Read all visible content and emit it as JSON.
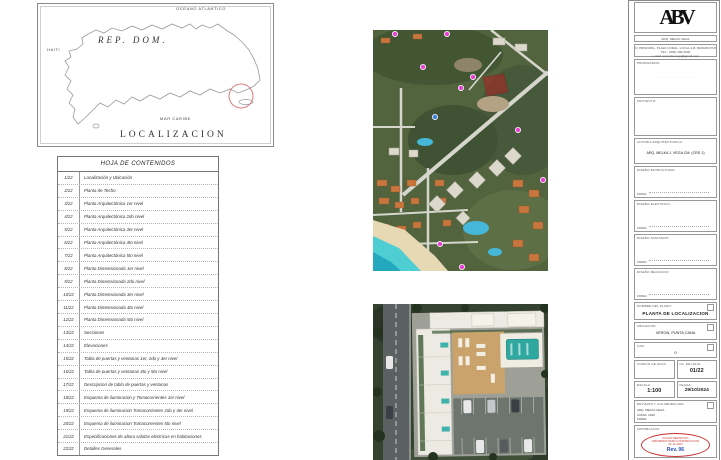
{
  "map": {
    "ocean": "OCEANO ATLANTICO",
    "country": "REP.  DOM.",
    "haiti": "HAITI",
    "sea": "MAR CARIBE",
    "title": "LOCALIZACION"
  },
  "toc": {
    "title": "HOJA DE CONTENIDOS",
    "rows": [
      {
        "n": "1/22",
        "d": "Localización y Ubicación"
      },
      {
        "n": "2/22",
        "d": "Planta de Techo"
      },
      {
        "n": "3/22",
        "d": "Planta  Arquitectónica   1er nivel"
      },
      {
        "n": "4/22",
        "d": "Planta  Arquitectónica   2do nivel"
      },
      {
        "n": "5/22",
        "d": "Planta  Arquitectónica   3er nivel"
      },
      {
        "n": "6/22",
        "d": "Planta  Arquitectónica   4to  nivel"
      },
      {
        "n": "7/22",
        "d": "Planta  Arquitectónica   5to  nivel"
      },
      {
        "n": "8/22",
        "d": "Planta  Dimensionada   1er nivel"
      },
      {
        "n": "9/22",
        "d": "Planta  Dimensionada   2do nivel"
      },
      {
        "n": "10/22",
        "d": "Planta  Dimensionada 3er nivel"
      },
      {
        "n": "11/22",
        "d": "Planta  Dimensionada 4to nivel"
      },
      {
        "n": "12/22",
        "d": "Planta  Dimensionada 5to nivel"
      },
      {
        "n": "13/22",
        "d": "Secciones"
      },
      {
        "n": "14/22",
        "d": "Elevaciones"
      },
      {
        "n": "15/22",
        "d": "Tabla de puertas y ventanas 1er, 2do y 3er nivel"
      },
      {
        "n": "16/22",
        "d": "Tabla de puertas y ventanas 4to y 5to nivel"
      },
      {
        "n": "17/22",
        "d": "Descripcion de tabla de puertas y ventanas"
      },
      {
        "n": "18/22",
        "d": "Esquema de iluminacion y Tomacorrientes 1er nivel"
      },
      {
        "n": "19/22",
        "d": "Esquema de iluminacion Tomacorrientes 2do y 3er nivel"
      },
      {
        "n": "20/22",
        "d": "Esquema de iluminacion Tomacorrientes 5to nivel"
      },
      {
        "n": "21/22",
        "d": "Especificaciones de altura salidas electricas  en habitaciones"
      },
      {
        "n": "22/22",
        "d": "Detalles Generales"
      }
    ]
  },
  "titleblock": {
    "logo": "ABV",
    "firm": "ARQ. MELKA VEGA",
    "contact": [
      "C/ PRINCIPAL, PLAZA CORAL, LOCAL 2-B, BAVARO PUNTA CANA",
      "TEL.: (809) 000-0000",
      "e-mail: arqmelkavega@gmail.com"
    ],
    "owner_label": "PROPIETARIO:",
    "owner_placeholder": "· · · · · · · · · · · · · · · · · · · · · ·",
    "project_label": "PROYECTO:",
    "author_label": "AUTORIA ARQUITECTONICA:",
    "author_value": "ARQ. MELKA J. VEGA CM. (CRD 1)",
    "designers": [
      {
        "label": "DISEÑO ESTRUCTURAL:",
        "firma": "FIRMA:"
      },
      {
        "label": "DISEÑO ELECTRICO:",
        "firma": "FIRMA:"
      },
      {
        "label": "DISEÑO SANITARIO:",
        "firma": "FIRMA:"
      },
      {
        "label": "DISEÑO MECANICO:",
        "firma": "FIRMA:"
      }
    ],
    "plano_label": "NOMBRE DEL PLANO:",
    "plano_value": "PLANTA DE LOCALIZACION",
    "ubicacion_label": "UBICACION:",
    "ubicacion_value": "VERON, PUNTA CANA",
    "cad_label": "CAD:",
    "cad_value": "0",
    "codigo_label": "CODIGO DE HOJA:",
    "nohoja_label": "No. DE HOJA:",
    "nohoja_value": "01/22",
    "escala_label": "ESCALA:",
    "escala_value": "1:100",
    "fecha_label": "FECHA:",
    "fecha_value": "29/10/2024",
    "revision_label": "REVISION Y COLABORACION:",
    "revision_lines": [
      "ARQ. MELKA VEGA",
      "CODIA: 2630",
      "FIRMA:"
    ],
    "stamp_label": "APROBACION:",
    "stamp_lines": [
      "PLANO DEFINITIVO",
      "APROBADO PARA CONSTRUCCION",
      "21-11-2024"
    ],
    "stamp_rev": "Rev. 06"
  }
}
